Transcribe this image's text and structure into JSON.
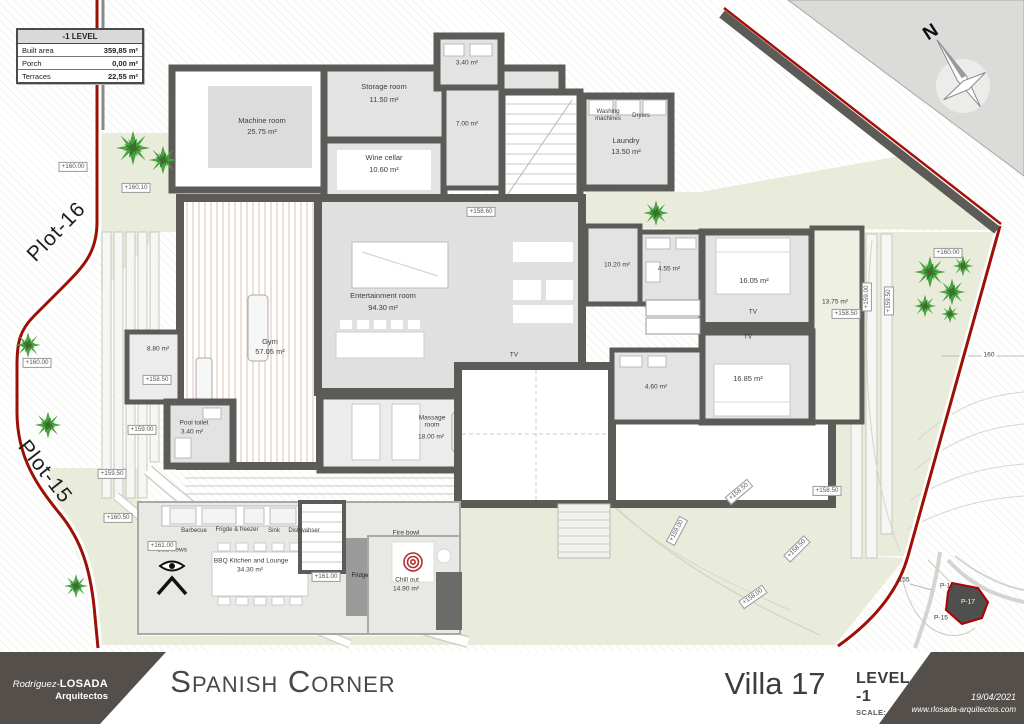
{
  "table": {
    "header": "-1 LEVEL",
    "rows": [
      {
        "label": "Built area",
        "value": "359,85 m²"
      },
      {
        "label": "Porch",
        "value": "0,00 m²"
      },
      {
        "label": "Terraces",
        "value": "22,55 m²"
      }
    ]
  },
  "plots": {
    "p16": "Plot-16",
    "p15": "Plot-15"
  },
  "compass": {
    "north": "N"
  },
  "rooms": {
    "machine": {
      "name": "Machine room",
      "area": "25.75 m²"
    },
    "storage": {
      "name": "Storage room",
      "area": "11.50 m²"
    },
    "toilet340": {
      "area": "3.40 m²"
    },
    "hall700": {
      "area": "7.00 m²"
    },
    "wine": {
      "name": "Wine cellar",
      "area": "10.60 m²"
    },
    "washing": {
      "line1": "Washing",
      "line2": "machines"
    },
    "dryers": {
      "label": "Dryers"
    },
    "laundry": {
      "name": "Laundry",
      "area": "13.50 m²"
    },
    "entertainment": {
      "name": "Entertainment room",
      "area": "94.30 m²"
    },
    "gym": {
      "name": "Gym",
      "area": "57.05 m²"
    },
    "room880": {
      "area": "8.80 m²"
    },
    "pool_toilet": {
      "name": "Pool toilet",
      "area": "3.40 m²"
    },
    "massage": {
      "line1": "Massage",
      "line2": "room",
      "area": "18.00 m²"
    },
    "hall1020": {
      "area": "10.20 m²"
    },
    "bath455": {
      "area": "4.55 m²"
    },
    "bedroom1": {
      "area": "16.05 m²"
    },
    "bedroom2": {
      "area": "16.85 m²"
    },
    "bath460": {
      "area": "4.60 m²"
    },
    "terrace": {
      "area": "13.75 m²"
    },
    "tv": {
      "label": "TV"
    },
    "kitchen": {
      "name": "BBQ Kitchen and Lounge",
      "area": "34.30 m²"
    },
    "chill": {
      "name": "Chill out",
      "area": "14.90 m²"
    },
    "fire_bowl": {
      "label": "Fire bowl"
    },
    "fridge": {
      "label": "Fridge"
    },
    "sea_views": {
      "label": "Sea views"
    },
    "appliances": {
      "barbecue": "Barbecue",
      "fridge_freezer": "Frigde & freezer",
      "sink": "Sink",
      "dishwasher": "Dishwahser"
    }
  },
  "markers": [
    {
      "t": "+160.00"
    },
    {
      "t": "+160.10"
    },
    {
      "t": "+160.00"
    },
    {
      "t": "+158.50"
    },
    {
      "t": "+159.00"
    },
    {
      "t": "+159.50"
    },
    {
      "t": "+160.50"
    },
    {
      "t": "+161.00"
    },
    {
      "t": "+161.00"
    },
    {
      "t": "+158.60"
    },
    {
      "t": "+158.50"
    },
    {
      "t": "+160.00"
    },
    {
      "t": "+159.00"
    },
    {
      "t": "+159.50"
    },
    {
      "t": "+158.50"
    },
    {
      "t": "+158.50"
    },
    {
      "t": "+159.00"
    },
    {
      "t": "+158.50"
    },
    {
      "t": "+158.00"
    }
  ],
  "contours": {
    "c160": "160",
    "c155": "155"
  },
  "minimap": {
    "p16": "P-16",
    "p17": "P-17",
    "p15": "P-15"
  },
  "titlebar": {
    "firm_script": "Rodríguez-",
    "firm_bold": "LOSADA",
    "firm_sub": "Arquitectos",
    "project": "Spanish Corner",
    "villa": "Villa 17",
    "level": "LEVEL -1",
    "scale": "SCALE: 1/100",
    "date": "19/04/2021",
    "website": "www.rlosada-arquitectos.com"
  }
}
